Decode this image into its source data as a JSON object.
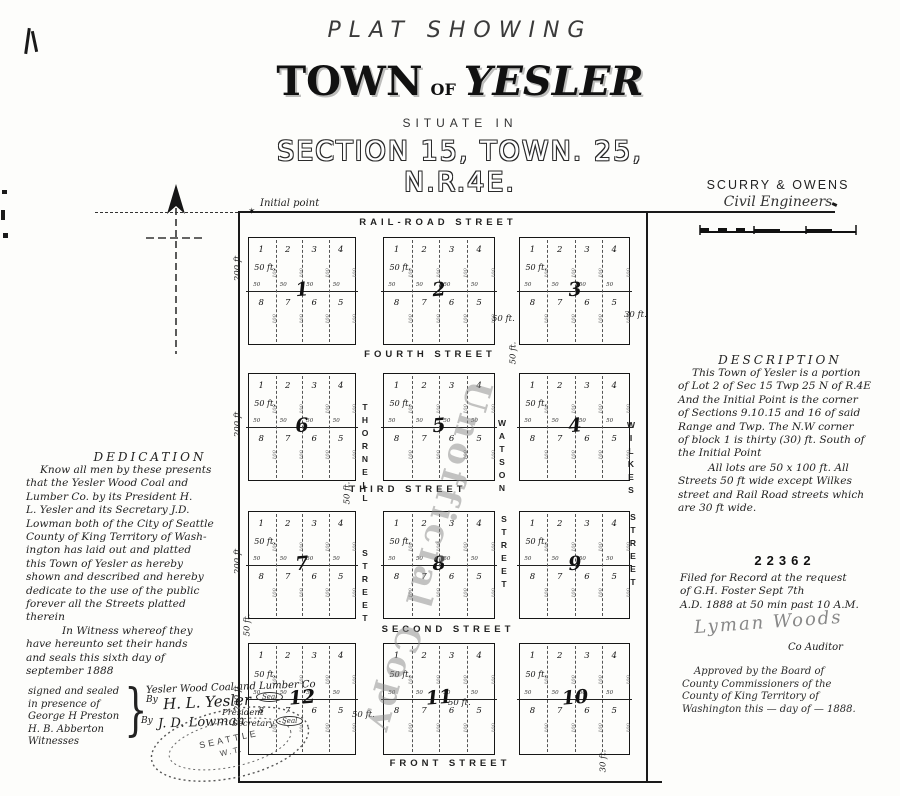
{
  "title": {
    "kicker": "PLAT SHOWING",
    "main_word1": "TOWN",
    "main_of": "OF",
    "main_word2": "YESLER",
    "sub1": "SITUATE IN",
    "sub2": "SECTION 15, TOWN. 25, N.R.4E."
  },
  "engineers": {
    "name": "SCURRY & OWENS",
    "title": "Civil Engineers"
  },
  "watermark_text": "Unofficial Copy",
  "map": {
    "initial_point_label": "Initial point",
    "streets_h": [
      "RAIL-ROAD STREET",
      "FOURTH STREET",
      "THIRD STREET",
      "SECOND STREET",
      "FRONT STREET"
    ],
    "streets_v": [
      [
        "THORNELL",
        "STREET"
      ],
      [
        "WATSON",
        "STREET"
      ],
      [
        "WILKES",
        "STREET"
      ]
    ],
    "block_numbers": [
      [
        "1",
        "2",
        "3"
      ],
      [
        "6",
        "5",
        "4"
      ],
      [
        "7",
        "8",
        "9"
      ],
      [
        "12",
        "11",
        "10"
      ]
    ],
    "lot_top": [
      "1",
      "2",
      "3",
      "4"
    ],
    "lot_bottom": [
      "8",
      "7",
      "6",
      "5"
    ],
    "lot_label": "50 ft.",
    "tick50": "50",
    "tick100": "100",
    "depth_label": "200 ft.",
    "fifty_label": "50 ft.",
    "thirty_label": "30 ft."
  },
  "dedication": {
    "heading": "DEDICATION",
    "body": [
      "Know all men by these presents",
      "that the Yesler Wood Coal and",
      "Lumber Co. by its President H.",
      "L. Yesler and its Secretary J.D.",
      "Lowman both of the City of Seattle",
      "County of King Territory of Wash-",
      "ington  has laid out and platted",
      "this Town of Yesler as hereby",
      "shown and described and hereby",
      "dedicate to the use of the public",
      "forever all the Streets platted",
      "therein",
      "In Witness whereof they",
      "have hereunto set their hands",
      "and seals this sixth day of",
      "september 1888"
    ]
  },
  "witness": {
    "lines": [
      "signed and sealed",
      "in presence of",
      "George H Preston",
      "H. B. Abberton",
      "Witnesses"
    ],
    "company": "Yesler Wood Coal and Lumber Co",
    "by": "By",
    "sig1": "H. L. Yesler",
    "sig1_title": "President",
    "sig2": "J. D. Lowman",
    "sig2_title": "Secretary",
    "seal_word": "Seal"
  },
  "notary_seal": {
    "line1": "SEATTLE",
    "line2": "W.T."
  },
  "description": {
    "heading": "DESCRIPTION",
    "para1": [
      "This Town of Yesler is a portion",
      "of Lot 2 of Sec 15 Twp 25 N of R.4E",
      "And the Initial Point is the corner",
      "of Sections 9.10.15 and 16 of said",
      "Range and Twp.  The N.W corner",
      "of block 1 is thirty (30) ft. South of",
      "the Initial Point"
    ],
    "para2": [
      "All lots are 50 x 100 ft. All",
      "Streets 50 ft wide except Wilkes",
      "street and Rail Road streets which",
      "are 30 ft wide."
    ]
  },
  "filing": {
    "number": "22362",
    "lines": [
      "Filed for Record at the request",
      "of G.H. Foster  Sept 7th",
      "A.D. 1888 at 50 min past 10 A.M."
    ],
    "signature": "Lyman Woods",
    "signature_title": "Co Auditor"
  },
  "approval": {
    "lines": [
      "Approved by the Board of",
      "County Commissioners of the",
      "County of King Territory of",
      "Washington this — day of — 1888."
    ]
  }
}
